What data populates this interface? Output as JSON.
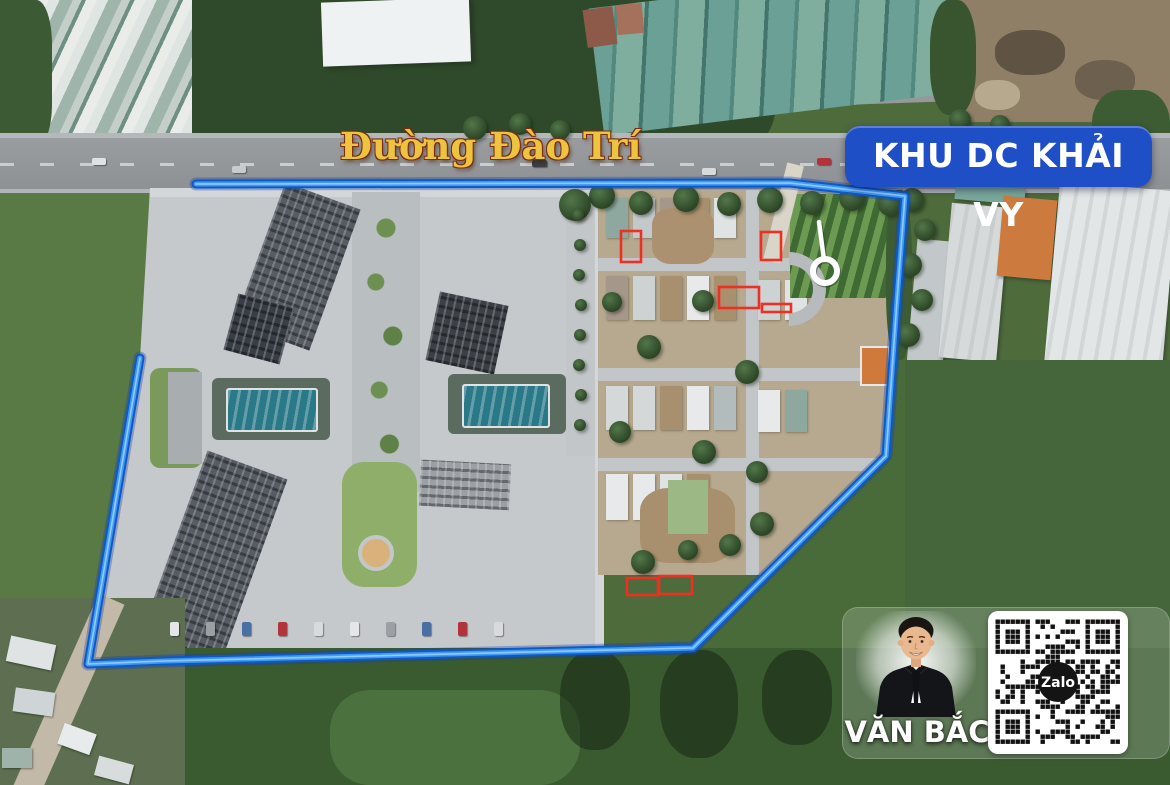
{
  "map": {
    "road_label": "Đường Đào Trí",
    "area_badge": "KHU DC KHẢI VY"
  },
  "agent_card": {
    "name": "VĂN BẮC",
    "qr_brand": "Zalo"
  },
  "colors": {
    "badge_blue": "#1e4fc7",
    "boundary_blue_outer": "#1257c7",
    "boundary_blue_inner": "#3f9bf3",
    "boundary_highlight": "#8ecbff",
    "lot_red": "#ee2f24",
    "road_label_gold": "#edc33f",
    "marker_white": "#ffffff"
  },
  "annotations": {
    "boundary_points": [
      [
        196,
        184
      ],
      [
        790,
        183
      ],
      [
        905,
        196
      ],
      [
        897,
        300
      ],
      [
        886,
        456
      ],
      [
        693,
        648
      ],
      [
        165,
        661
      ],
      [
        88,
        664
      ],
      [
        140,
        358
      ]
    ],
    "red_boxes": [
      [
        621,
        231,
        20,
        31
      ],
      [
        761,
        232,
        20,
        28
      ],
      [
        719,
        287,
        40,
        21
      ],
      [
        762,
        304,
        29,
        8
      ],
      [
        627,
        578,
        31,
        17
      ],
      [
        659,
        576,
        33,
        18
      ]
    ],
    "ring_marker": {
      "cx": 825,
      "cy": 271,
      "r": 12,
      "stem_x1": 819,
      "stem_y1": 222,
      "stem_x2": 824,
      "stem_y2": 260
    }
  }
}
